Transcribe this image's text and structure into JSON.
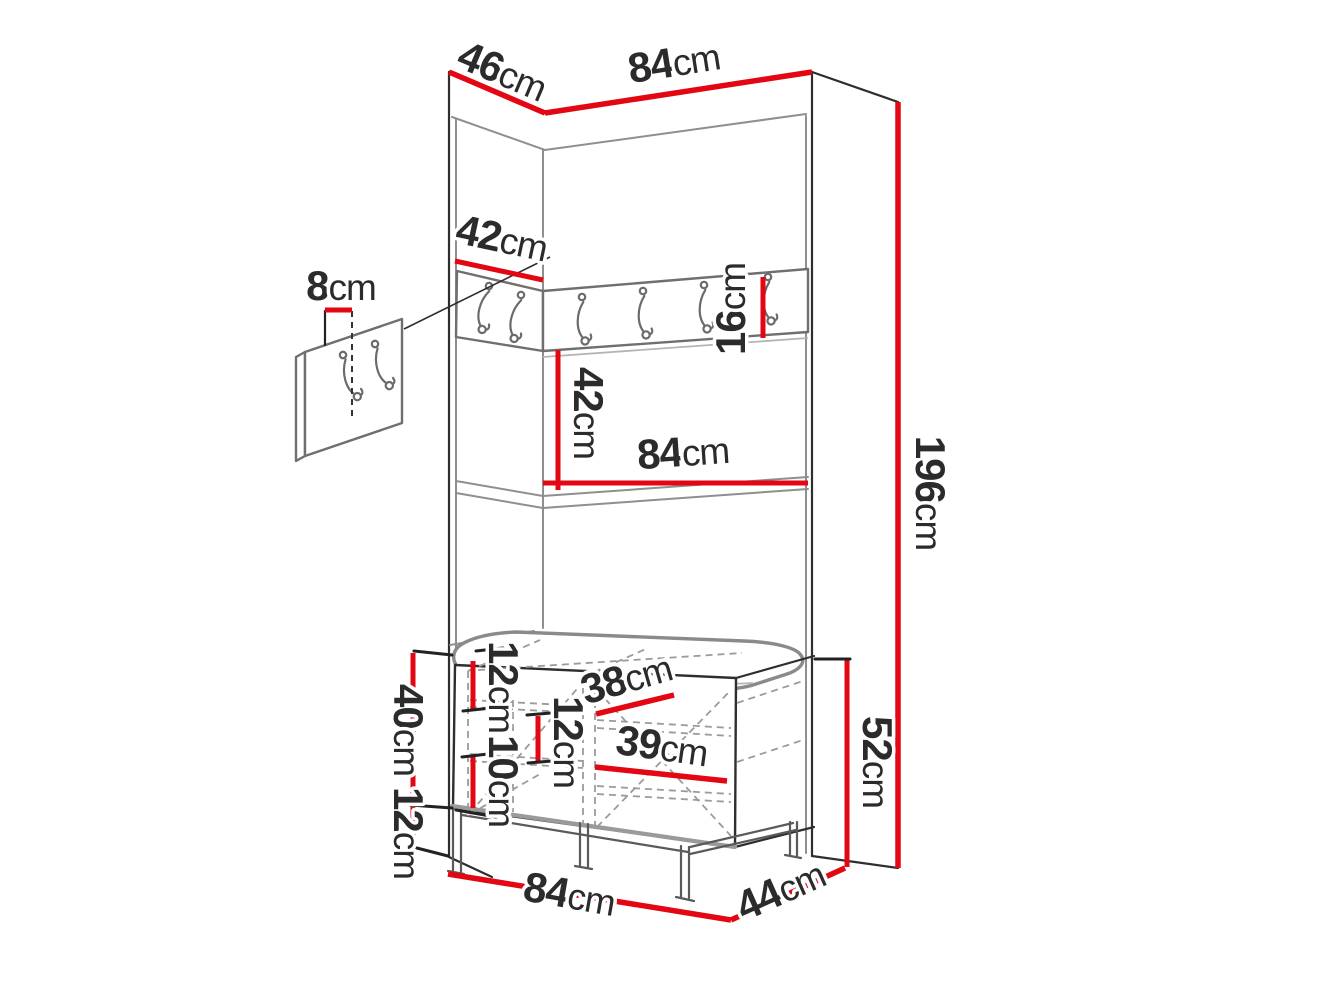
{
  "diagram": {
    "kind": "furniture-dimension-diagram",
    "accent_color": "#e30613",
    "outline_color": "#2e2e2e",
    "soft_outline_color": "#8f8f8f"
  },
  "dimensions": {
    "top_depth": {
      "value": "46",
      "unit": "cm"
    },
    "top_width": {
      "value": "84",
      "unit": "cm"
    },
    "rail_depth": {
      "value": "42",
      "unit": "cm"
    },
    "wall_panel_width": {
      "value": "8",
      "unit": "cm"
    },
    "rail_height": {
      "value": "16",
      "unit": "cm"
    },
    "mid_height": {
      "value": "42",
      "unit": "cm"
    },
    "mid_width": {
      "value": "84",
      "unit": "cm"
    },
    "total_height": {
      "value": "196",
      "unit": "cm"
    },
    "bench_body_height": {
      "value": "40",
      "unit": "cm"
    },
    "leg_height": {
      "value": "12",
      "unit": "cm"
    },
    "bench_top_gap": {
      "value": "12",
      "unit": "cm"
    },
    "bench_mid_gap": {
      "value": "12",
      "unit": "cm"
    },
    "bench_bottom_gap": {
      "value": "10",
      "unit": "cm"
    },
    "bench_shelf_upper": {
      "value": "38",
      "unit": "cm"
    },
    "bench_shelf_lower": {
      "value": "39",
      "unit": "cm"
    },
    "bench_total_height": {
      "value": "52",
      "unit": "cm"
    },
    "bench_width": {
      "value": "84",
      "unit": "cm"
    },
    "bench_depth": {
      "value": "44",
      "unit": "cm"
    }
  }
}
